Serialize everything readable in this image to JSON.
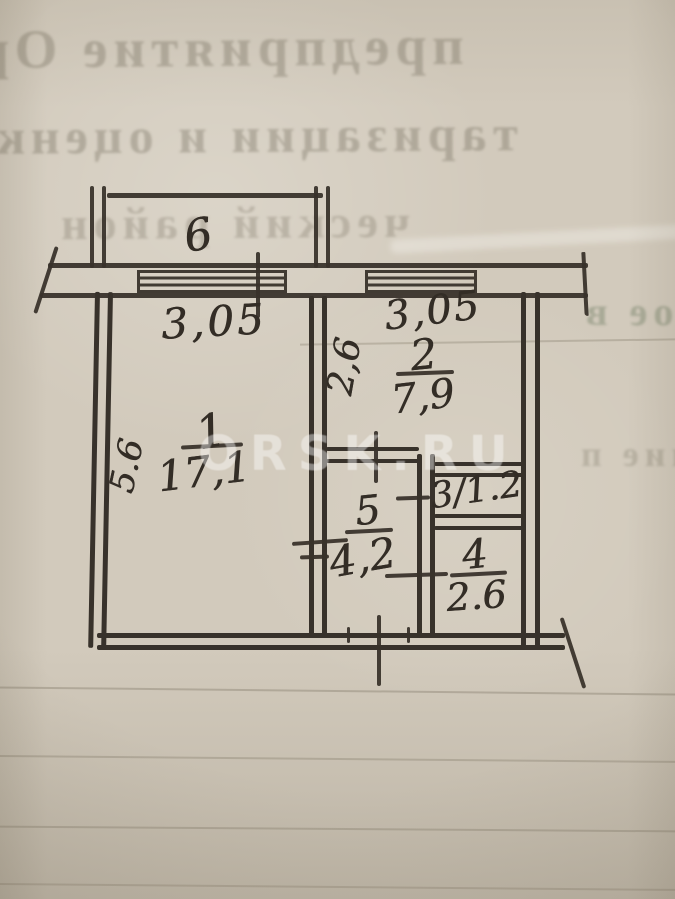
{
  "watermark": {
    "text": "ORSK.RU"
  },
  "balcony": {
    "number": "6"
  },
  "rooms": {
    "r1": {
      "number": "1",
      "area": "17,1"
    },
    "r2": {
      "number": "2",
      "area": "7,9"
    },
    "r3": {
      "label": "3/1.2"
    },
    "r4": {
      "number": "4",
      "area": "2.6"
    },
    "r5": {
      "number": "5",
      "area": "4,2"
    }
  },
  "dimensions": {
    "window_left_width": "3,05",
    "window_right_width": "3,05",
    "room2_depth": "2,6",
    "room1_depth": "5.6"
  },
  "bleed_through_text": {
    "line1": "предприятие Ор",
    "line2": "таризации и оценк",
    "line3": "ческий район",
    "line4": "ое в",
    "line5": "ние п"
  },
  "colors": {
    "paper": "#d2cabc",
    "ink": "#38322b",
    "watermark": "#ffffff"
  }
}
